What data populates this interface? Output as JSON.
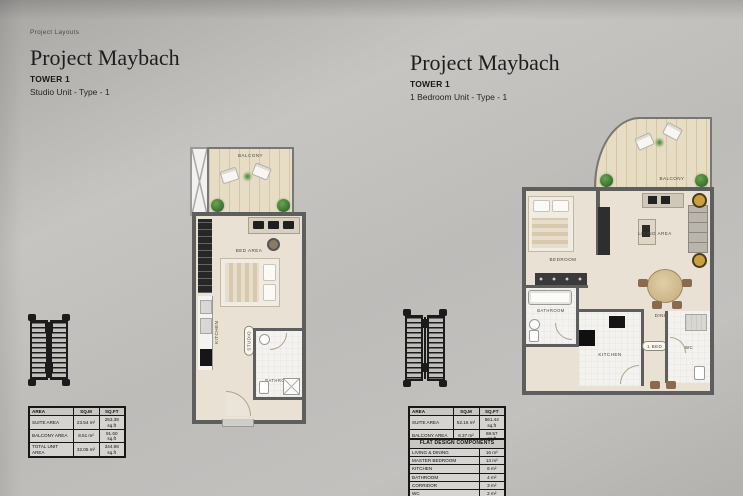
{
  "page": {
    "eyebrow": "Project Layouts"
  },
  "colors": {
    "background": "#bcbab7",
    "wall": "#5e5e5e",
    "wood_floor": "#e7ddc5",
    "room_floor": "#e9e1d3",
    "tile_floor": "#f3f2ef",
    "plant_green": "#3f7d35",
    "table_ink": "#161616",
    "gold_accent": "#c8a13e"
  },
  "left_unit": {
    "title": "Project Maybach",
    "tower": "TOWER 1",
    "unit_type": "Studio Unit - Type - 1",
    "rooms": {
      "balcony": "BALCONY",
      "bed_area": "BED AREA",
      "kitchen": "KITCHEN",
      "studio": "STUDIO",
      "bathroom": "BATHROOM"
    },
    "area_table": {
      "headers": [
        "AREA",
        "SQ.M",
        "SQ.FT"
      ],
      "rows": [
        {
          "label": "SUITE AREA",
          "sqm": "23.54 m²",
          "sqft": "253.38 sq.ft"
        },
        {
          "label": "BALCONY AREA",
          "sqm": "8.51 m²",
          "sqft": "91.60 sq.ft"
        },
        {
          "label": "TOTAL UNIT AREA",
          "sqm": "32.05 m²",
          "sqft": "344.98 sq.ft"
        }
      ]
    }
  },
  "right_unit": {
    "title": "Project Maybach",
    "tower": "TOWER 1",
    "unit_type": "1 Bedroom Unit - Type - 1",
    "rooms": {
      "balcony": "BALCONY",
      "bedroom": "BEDROOM",
      "living": "LIVING AREA",
      "dining": "DINING",
      "bathroom": "BATHROOM",
      "kitchen": "KITCHEN",
      "bed_tag": "1 BED",
      "wc": "WC"
    },
    "area_table": {
      "headers": [
        "AREA",
        "SQ.M",
        "SQ.FT"
      ],
      "rows": [
        {
          "label": "SUITE AREA",
          "sqm": "52.16 m²",
          "sqft": "561.44 sq.ft"
        },
        {
          "label": "BALCONY AREA",
          "sqm": "6.37 m²",
          "sqft": "68.57 sq.ft"
        },
        {
          "label": "TOTAL UNIT AREA",
          "sqm": "58.53 m²",
          "sqft": "630.01 sq.ft"
        }
      ]
    },
    "components_table": {
      "title": "FLAT DESIGN COMPONENTS",
      "rows": [
        {
          "label": "LIVING & DINING",
          "value": "16 m²"
        },
        {
          "label": "MASTER BEDROOM",
          "value": "13 m²"
        },
        {
          "label": "KITCHEN",
          "value": "6 m²"
        },
        {
          "label": "BATHROOM",
          "value": "4 m²"
        },
        {
          "label": "CORRIDOR",
          "value": "3 m²"
        },
        {
          "label": "WC",
          "value": "2 m²"
        }
      ]
    }
  }
}
